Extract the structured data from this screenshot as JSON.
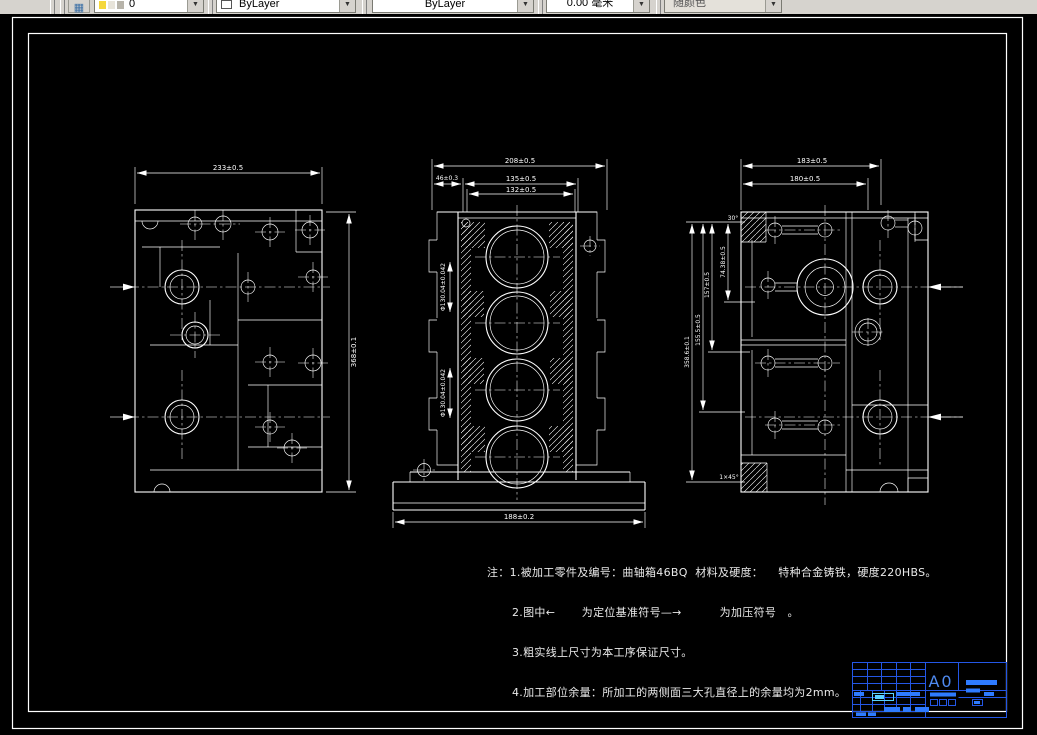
{
  "toolbar": {
    "layer_value": "0",
    "color_value": "ByLayer",
    "linetype_value": "ByLayer",
    "lineweight_value": "0.00 毫米",
    "plotstyle_value": "随颜色"
  },
  "views": {
    "left": {
      "dim_top": "233±0.5",
      "dim_right": "368±0.1"
    },
    "middle": {
      "dim_top": "208±0.5",
      "dim_width_upper": "135±0.5",
      "dim_width_lower": "132±0.5",
      "dim_small_left": "46±0.3",
      "dim_bottom": "188±0.2",
      "bore_dim_upper": "Φ130.04±0.042",
      "bore_dim_lower": "Φ130.04±0.042"
    },
    "right": {
      "dim_top_outer": "183±0.5",
      "dim_top_inner": "180±0.5",
      "left_dims": [
        "358.6±0.1",
        "155.5±0.5",
        "157±0.5",
        "74.38±0.5"
      ],
      "angle_note": "30°",
      "chamfer_note": "1×45°"
    }
  },
  "notes": {
    "line1": "注：1.被加工零件及编号：曲轴箱46BQ  材料及硬度：    特种合金铸铁，硬度220HBS。",
    "line2": "2.图中←       为定位基准符号—→          为加压符号   。",
    "line3": "3.粗实线上尺寸为本工序保证尺寸。",
    "line4": "4.加工部位余量：所加工的两侧面三大孔直径上的余量均为2mm。"
  },
  "titleblock": {
    "sheet_size": "A0"
  },
  "colors": {
    "canvas": "#000000",
    "line": "#ffffff",
    "titleblock_stroke": "#2457e6",
    "titleblock_fill": "#2e7bff",
    "titleblock_accent": "#59d1ff",
    "toolbar_bg": "#d6d3ce"
  }
}
